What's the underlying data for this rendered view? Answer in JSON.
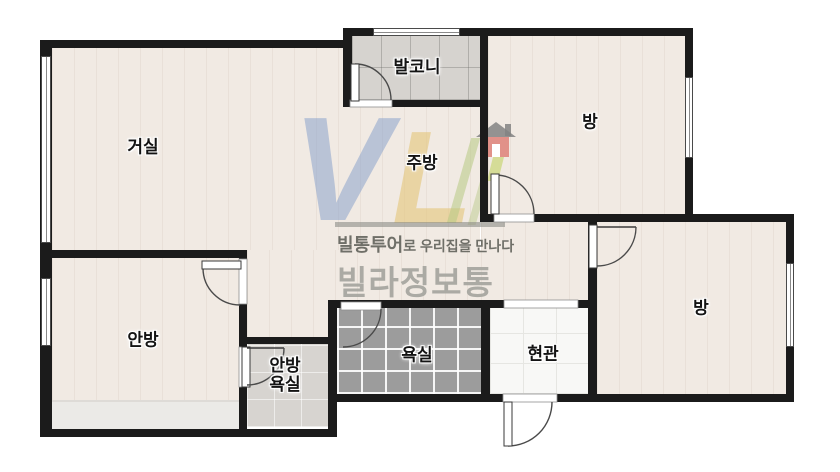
{
  "floorplan": {
    "rooms": {
      "living": {
        "label": "거실"
      },
      "balcony": {
        "label": "발코니"
      },
      "kitchen": {
        "label": "주방"
      },
      "bedroom_top_right": {
        "label": "방"
      },
      "bedroom_bottom_right": {
        "label": "방"
      },
      "master_bedroom": {
        "label": "안방"
      },
      "master_bathroom": {
        "label_line1": "안방",
        "label_line2": "욕실"
      },
      "bathroom": {
        "label": "욕실"
      },
      "entrance": {
        "label": "현관"
      }
    }
  },
  "watermark": {
    "logo_v": "V",
    "logo_l": "L",
    "tagline_brand": "빌통투어",
    "tagline_suffix": "로 우리집을 만나다",
    "brand": "빌라정보통"
  },
  "colors": {
    "wall": "#1b1b1b",
    "wood_floor": "#f1eae3",
    "balcony_tile": "#d6d3cf",
    "bathroom_tile": "#9c9c9c",
    "master_bathroom_tile": "#d7d4d0",
    "entrance_tile": "#f8f8f6",
    "logo_blue": "#8ba3cc",
    "logo_yellow": "#e4c77c",
    "logo_green": "#b6c883",
    "logo_red": "#dd7b72",
    "tagline_text": "#6f6f68",
    "brand_text": "#a7a7a0"
  }
}
